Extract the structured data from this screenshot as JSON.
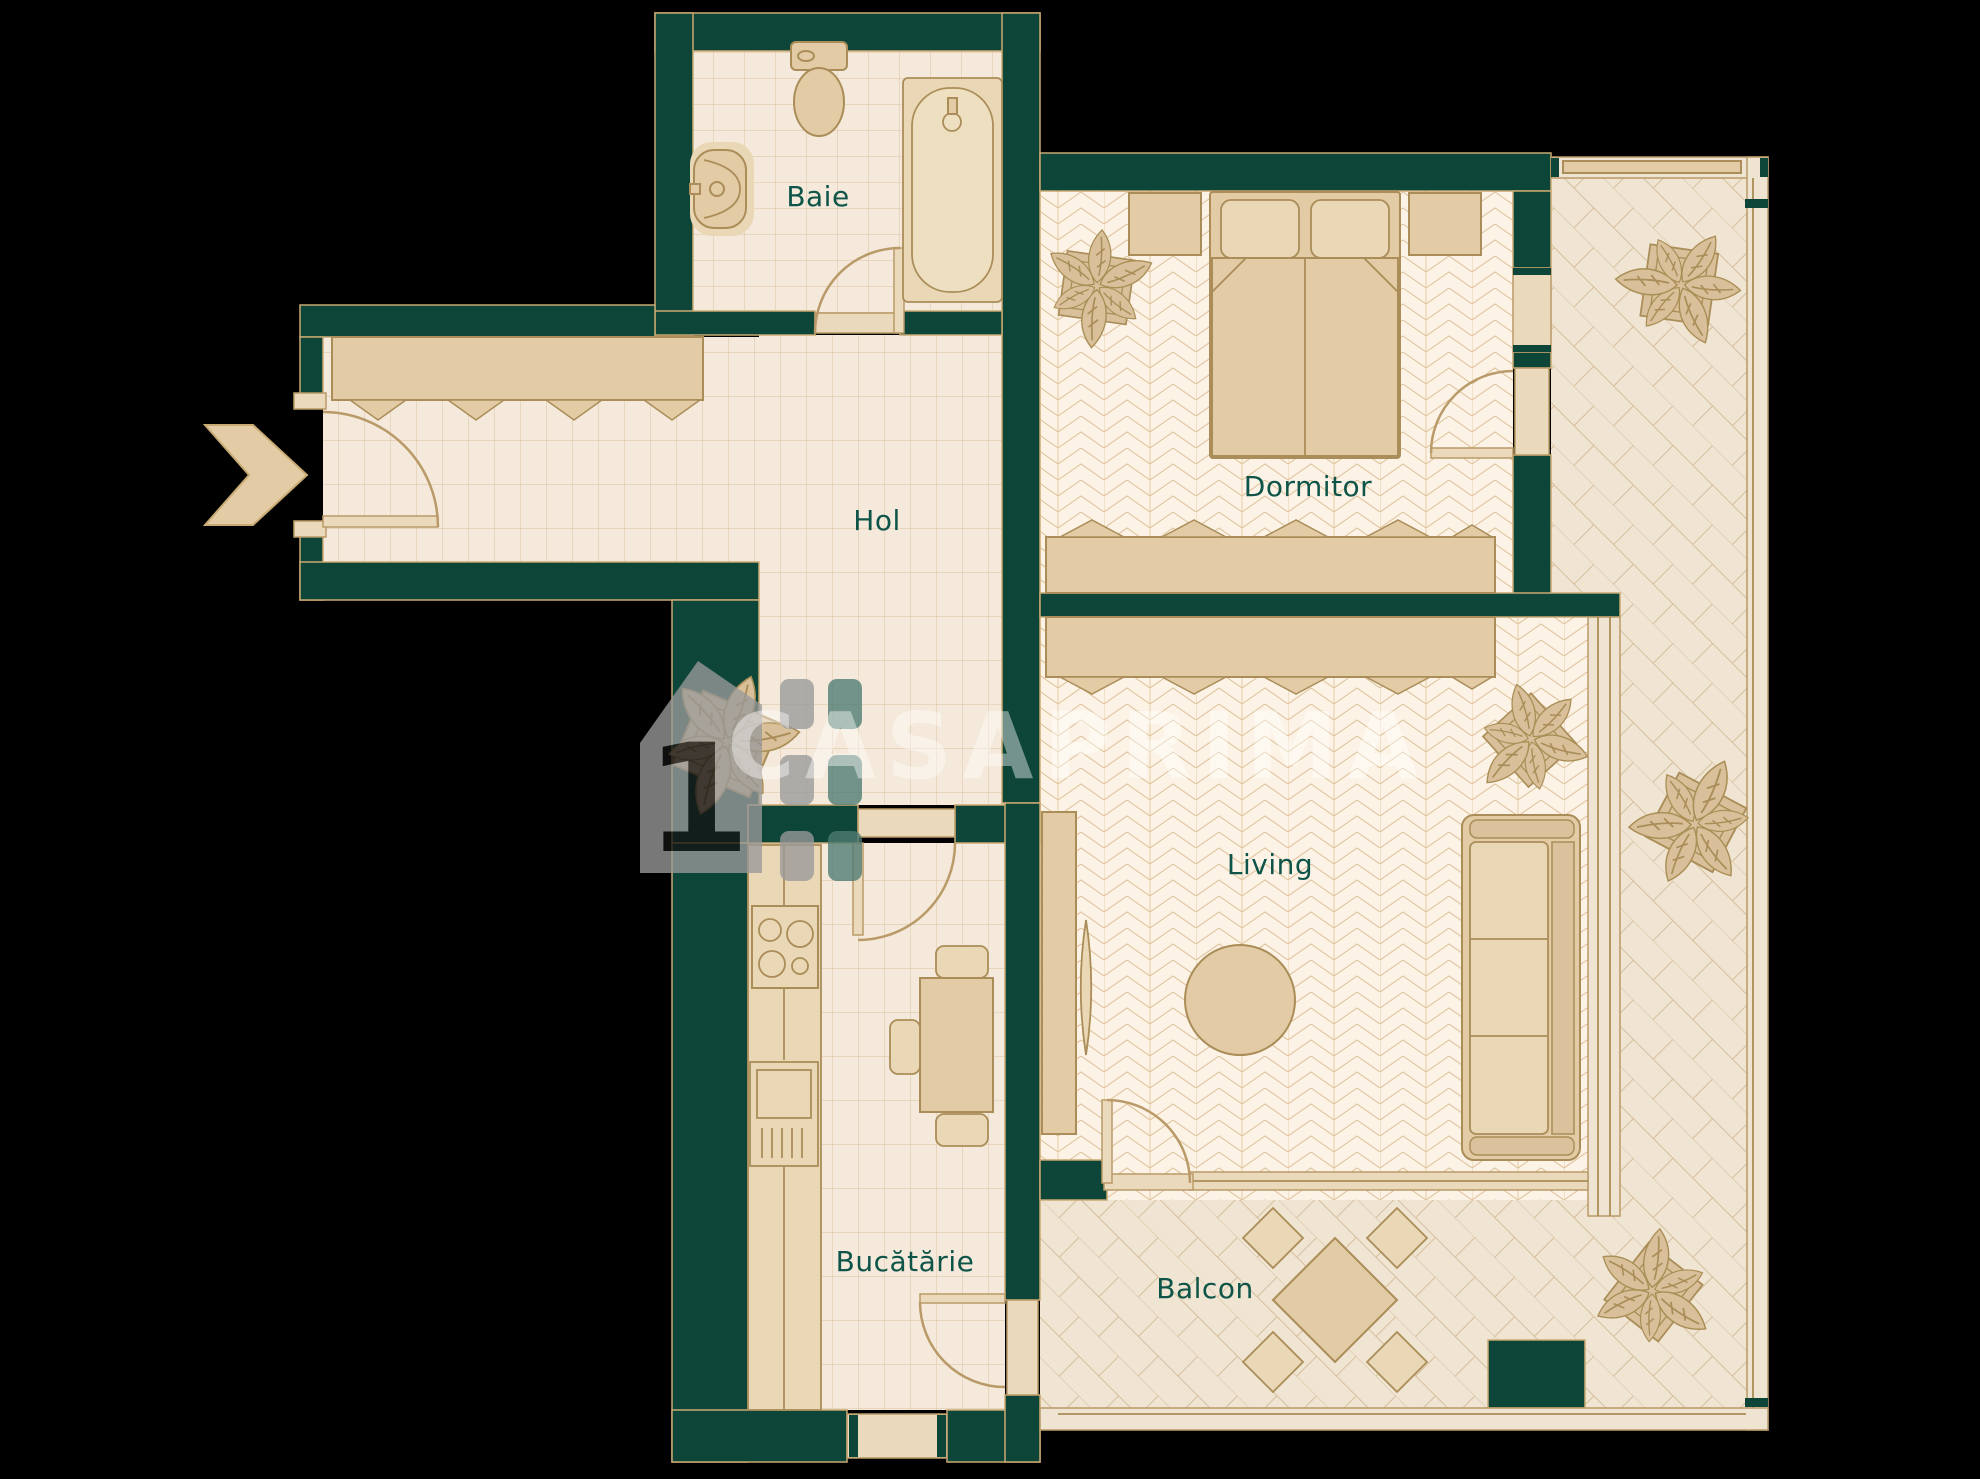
{
  "title": "Apartment floor plan",
  "watermark": {
    "text": "CASAPRIMA",
    "logo_digit": "1"
  },
  "rooms": {
    "baie": {
      "label": "Baie"
    },
    "hol": {
      "label": "Hol"
    },
    "dormitor": {
      "label": "Dormitor"
    },
    "living": {
      "label": "Living"
    },
    "bucatarie": {
      "label": "Bucătărie"
    },
    "balcon": {
      "label": "Balcon"
    }
  },
  "theme": {
    "bg": "#000000",
    "wall": "#0e4539",
    "wallline": "#c9aa72",
    "tilebg": "#f4e9da",
    "tileline": "#e0c9ab",
    "herrbg": "#fcf3e6",
    "herrline": "#dcbf96",
    "brickbg": "#f0e4d2",
    "brickline": "#d5bf9e",
    "furn": "#e2cba5",
    "furnline": "#aa8d58",
    "furnlight": "#e9d7b6",
    "light": "#ead9ba",
    "doorline": "#b99a68",
    "rail": "#efe3d1",
    "label": "#0e5448",
    "wm": "rgba(255,255,255,0.42)"
  }
}
